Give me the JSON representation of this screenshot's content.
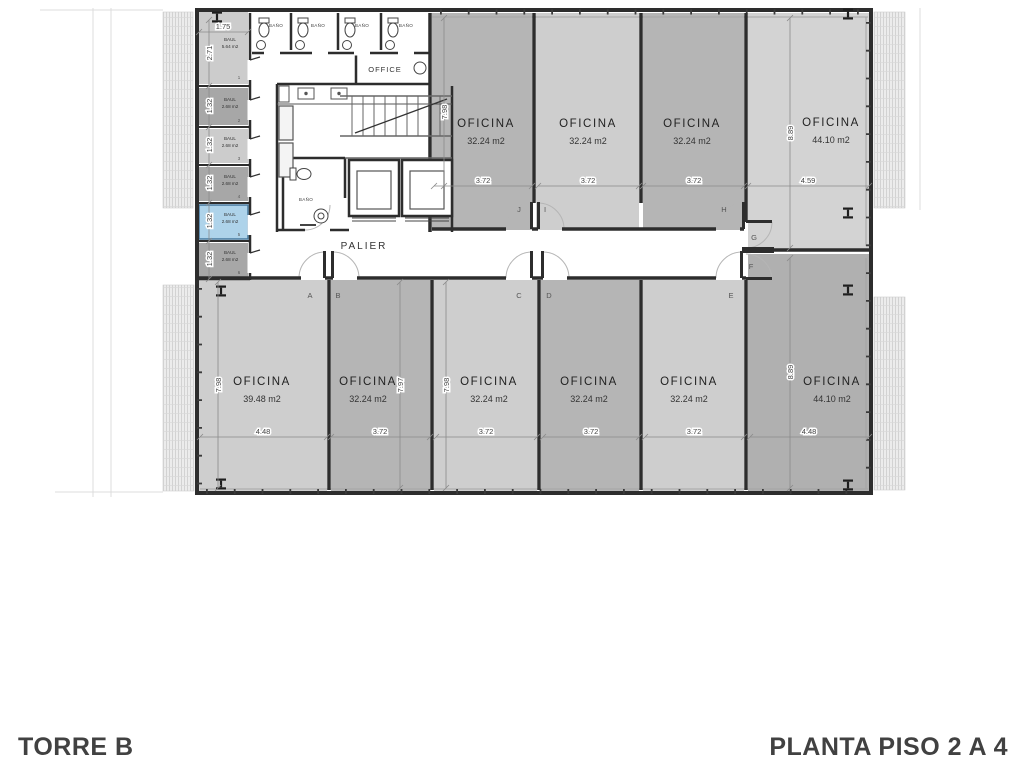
{
  "titles": {
    "tower": "TORRE B",
    "plan": "PLANTA PISO 2 A 4"
  },
  "labels": {
    "palier": "PALIER",
    "office_room": "OFFICE",
    "bathroom": "BAÑO",
    "storage": "BAUL"
  },
  "top_offices": [
    {
      "name": "OFICINA",
      "area": "32.24 m2",
      "width": "3.72",
      "door": "J"
    },
    {
      "name": "OFICINA",
      "area": "32.24 m2",
      "width": "3.72",
      "door": "I"
    },
    {
      "name": "OFICINA",
      "area": "32.24 m2",
      "width": "3.72",
      "door": "H"
    },
    {
      "name": "OFICINA",
      "area": "44.10 m2",
      "width": "4.59",
      "door": "G",
      "depth": "8.89"
    }
  ],
  "top_row_depth": "7.98",
  "bottom_offices": [
    {
      "name": "OFICINA",
      "area": "39.48 m2",
      "width": "4.48",
      "door": "A",
      "depth": "7.98"
    },
    {
      "name": "OFICINA",
      "area": "32.24 m2",
      "width": "3.72",
      "door": "B",
      "depth": "7.97"
    },
    {
      "name": "OFICINA",
      "area": "32.24 m2",
      "width": "3.72",
      "door": "C",
      "depth": "7.98"
    },
    {
      "name": "OFICINA",
      "area": "32.24 m2",
      "width": "3.72",
      "door": "D"
    },
    {
      "name": "OFICINA",
      "area": "32.24 m2",
      "width": "3.72",
      "door": "E"
    },
    {
      "name": "OFICINA",
      "area": "44.10 m2",
      "width": "4.48",
      "door": "F",
      "depth": "8.89"
    }
  ],
  "storage_units": [
    {
      "num": "1",
      "label": "BAUL",
      "area": "5.64 m2",
      "width": "1.75",
      "depth": "2.71"
    },
    {
      "num": "2",
      "label": "BAUL",
      "area": "2.68 m2",
      "depth": "1.32"
    },
    {
      "num": "3",
      "label": "BAUL",
      "area": "2.68 m2",
      "depth": "1.32"
    },
    {
      "num": "4",
      "label": "BAUL",
      "area": "2.68 m2",
      "depth": "1.32"
    },
    {
      "num": "5",
      "label": "BAUL",
      "area": "2.68 m2",
      "depth": "1.32",
      "highlighted": true
    },
    {
      "num": "6",
      "label": "BAUL",
      "area": "2.68 m2",
      "depth": "1.32"
    }
  ],
  "bathroom_labels": [
    "BAÑO",
    "BAÑO",
    "BAÑO",
    "BAÑO"
  ],
  "colors": {
    "office_dark": "#b5b5b5",
    "office_light": "#cecece",
    "office_lighter": "#d3d3d3",
    "office_br": "#b0b0b0",
    "storage_dark": "#a7a7a7",
    "storage_light": "#cccccc",
    "highlight_blue": "#aed3ea",
    "highlight_border": "#46789e",
    "wall": "#2d2d2d"
  }
}
